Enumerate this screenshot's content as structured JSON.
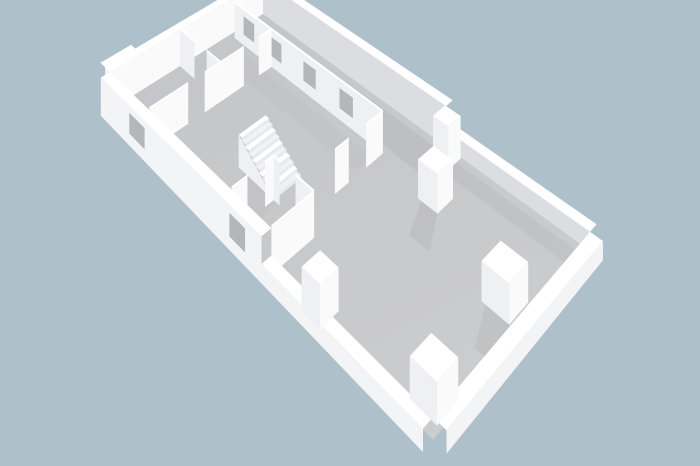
{
  "scene": {
    "palette": {
      "background": "#aec0ca",
      "floor_top": "#c4c5c8",
      "floor_bottom": "#cbccce",
      "shadow": "#b3b5b9",
      "shadow_soft": "#bdbfc2",
      "wall_cap": "#ffffff",
      "outer_face": "#f3f4f6",
      "face_light": "#fafafb",
      "face_mid": "#eef0f3",
      "face_shade": "#dbdde0",
      "window_hole": "#b4b6ba",
      "step_a": "#ffffff",
      "step_b": "#f1f2f5",
      "riser": "#e8eaed"
    },
    "projection": {
      "plan_width": 8,
      "plan_length": 16,
      "corner_north": [
        263,
        14
      ],
      "corner_west": [
        110,
        110
      ],
      "corner_east": [
        590,
        251
      ],
      "corner_south": [
        433,
        440
      ],
      "wall_px": 23
    },
    "items": [
      {
        "kind": "poly",
        "name": "floor",
        "fill": "floor-gradient",
        "pts": [
          [
            0,
            0
          ],
          [
            8,
            0
          ],
          [
            8,
            16
          ],
          [
            0,
            16
          ]
        ]
      },
      {
        "kind": "poly",
        "name": "shadow-ne-wall",
        "fill": "shadow",
        "opacity": 0.5,
        "pts": [
          [
            0.3,
            0.5
          ],
          [
            1.6,
            1.4
          ],
          [
            1.6,
            10.2
          ],
          [
            0.3,
            10.2
          ]
        ]
      },
      {
        "kind": "poly",
        "name": "shadow-ne-wall-low",
        "fill": "shadow",
        "opacity": 0.35,
        "pts": [
          [
            0.3,
            10.2
          ],
          [
            0.95,
            10.2
          ],
          [
            0.95,
            16
          ],
          [
            0.3,
            16
          ]
        ]
      },
      {
        "kind": "poly",
        "name": "shadow-room-wall",
        "fill": "shadow_soft",
        "opacity": 0.5,
        "pts": [
          [
            2.3,
            0.8
          ],
          [
            3.15,
            1.5
          ],
          [
            3.15,
            8.6
          ],
          [
            2.3,
            8.6
          ]
        ]
      },
      {
        "kind": "poly",
        "name": "shadow-stairs",
        "fill": "shadow_soft",
        "opacity": 0.55,
        "pts": [
          [
            6.1,
            5.9
          ],
          [
            7.3,
            6.7
          ],
          [
            7.3,
            7.9
          ],
          [
            6.1,
            7.5
          ]
        ]
      },
      {
        "kind": "wall",
        "name": "wall-ne-tall",
        "a": [
          0,
          0
        ],
        "b": [
          0,
          10.2
        ],
        "h": 1.45,
        "off": [
          -0.4,
          0
        ],
        "face": "face_shade"
      },
      {
        "kind": "wall",
        "name": "wall-ne-low",
        "a": [
          0,
          10.2
        ],
        "b": [
          0,
          16
        ],
        "h": 0.6,
        "off": [
          -0.4,
          0
        ],
        "face": "face_shade"
      },
      {
        "kind": "wall",
        "name": "wall-nw-step",
        "a": [
          6.55,
          -0.36
        ],
        "b": [
          8,
          -0.36
        ],
        "h": 1.45,
        "off": [
          0,
          -0.34
        ],
        "face": "outer_face"
      },
      {
        "kind": "wall",
        "name": "wall-nw",
        "a": [
          0,
          0
        ],
        "b": [
          8,
          0
        ],
        "h": 1.45,
        "off": [
          0,
          -0.4
        ],
        "face": "face_light"
      },
      {
        "kind": "wall",
        "name": "wall-room-ne",
        "a": [
          1.9,
          0.3
        ],
        "b": [
          1.9,
          8.8
        ],
        "h": 1.45,
        "face": "face_mid",
        "openings": [
          {
            "type": "window",
            "s": 0.071,
            "e": 0.153
          },
          {
            "type": "window",
            "s": 0.271,
            "e": 0.353
          },
          {
            "type": "window",
            "s": 0.506,
            "e": 0.588
          },
          {
            "type": "window",
            "s": 0.741,
            "e": 0.824
          }
        ]
      },
      {
        "kind": "wall",
        "name": "wall-room-divider-1",
        "a": [
          4.6,
          0
        ],
        "b": [
          4.6,
          2.7
        ],
        "h": 1.45,
        "face": "face_mid",
        "openings": [
          {
            "type": "door",
            "s": 0.37,
            "e": 0.667
          }
        ]
      },
      {
        "kind": "wall",
        "name": "wall-room-divider-2",
        "a": [
          1.9,
          2.7
        ],
        "b": [
          8,
          2.7
        ],
        "h": 1.45,
        "face": "face_light",
        "openings": [
          {
            "type": "door",
            "s": 0.115,
            "e": 0.246
          },
          {
            "type": "door",
            "s": 0.574,
            "e": 0.705
          }
        ]
      },
      {
        "kind": "stairs",
        "name": "staircase",
        "x": 4.8,
        "y": 5.6,
        "w": 1.3,
        "len": 1.9,
        "steps": 10,
        "h": 1.15
      },
      {
        "kind": "wall",
        "name": "wall-hall-1",
        "a": [
          6.1,
          7.5
        ],
        "b": [
          6.1,
          9.5
        ],
        "h": 1.45,
        "face": "face_mid",
        "openings": [
          {
            "type": "door",
            "s": 0.15,
            "e": 0.55
          }
        ]
      },
      {
        "kind": "wall",
        "name": "wall-hall-2",
        "a": [
          6.1,
          7.5
        ],
        "b": [
          8,
          7.5
        ],
        "h": 1.45,
        "face": "face_light",
        "openings": [
          {
            "type": "door",
            "s": 0.21,
            "e": 0.63
          }
        ]
      },
      {
        "kind": "wall",
        "name": "wall-room-end",
        "a": [
          1.9,
          8.8
        ],
        "b": [
          4.4,
          8.8
        ],
        "h": 1.45,
        "face": "face_light",
        "openings": [
          {
            "type": "door",
            "s": 0.36,
            "e": 0.72
          }
        ]
      },
      {
        "kind": "wall",
        "name": "wall-hall-3",
        "a": [
          6.1,
          9.5
        ],
        "b": [
          8,
          9.5
        ],
        "h": 1.45,
        "face": "face_light"
      },
      {
        "kind": "box",
        "name": "pier-ne",
        "x": 0.05,
        "y": 10.2,
        "w": 0.7,
        "d": 0.7,
        "h": 1.5,
        "shadow": true
      },
      {
        "kind": "box",
        "name": "pillar-1",
        "x": 1.6,
        "y": 10.9,
        "w": 0.85,
        "d": 0.85,
        "h": 1.3,
        "shadow": true
      },
      {
        "kind": "box",
        "name": "pillar-2",
        "x": 2.9,
        "y": 14.6,
        "w": 1.0,
        "d": 1.0,
        "h": 1.2,
        "shadow": true
      },
      {
        "kind": "wall",
        "name": "wall-sw-tall",
        "a": [
          8,
          0
        ],
        "b": [
          8,
          9.5
        ],
        "h": 1.45,
        "off": [
          0.42,
          0
        ],
        "out": true,
        "face": "outer_face",
        "openings": [
          {
            "type": "window",
            "s": 0.21,
            "e": 0.316
          },
          {
            "type": "window",
            "s": 0.832,
            "e": 0.916
          }
        ]
      },
      {
        "kind": "wall",
        "name": "wall-sw-low",
        "a": [
          8,
          9.5
        ],
        "b": [
          8,
          16
        ],
        "h": 0.6,
        "off": [
          0.42,
          0
        ],
        "out": true,
        "face": "outer_face"
      },
      {
        "kind": "box",
        "name": "pillar-3",
        "x": 7.3,
        "y": 11.0,
        "w": 0.8,
        "d": 0.8,
        "h": 1.3,
        "shadow": false
      },
      {
        "kind": "wall",
        "name": "wall-se-low",
        "a": [
          0,
          16
        ],
        "b": [
          8,
          16
        ],
        "h": 0.6,
        "off": [
          0,
          0.45
        ],
        "out": true,
        "face": "outer_face"
      },
      {
        "kind": "box",
        "name": "pillar-4",
        "x": 6.7,
        "y": 14.9,
        "w": 0.95,
        "d": 0.95,
        "h": 1.15,
        "shadow": false
      }
    ]
  }
}
